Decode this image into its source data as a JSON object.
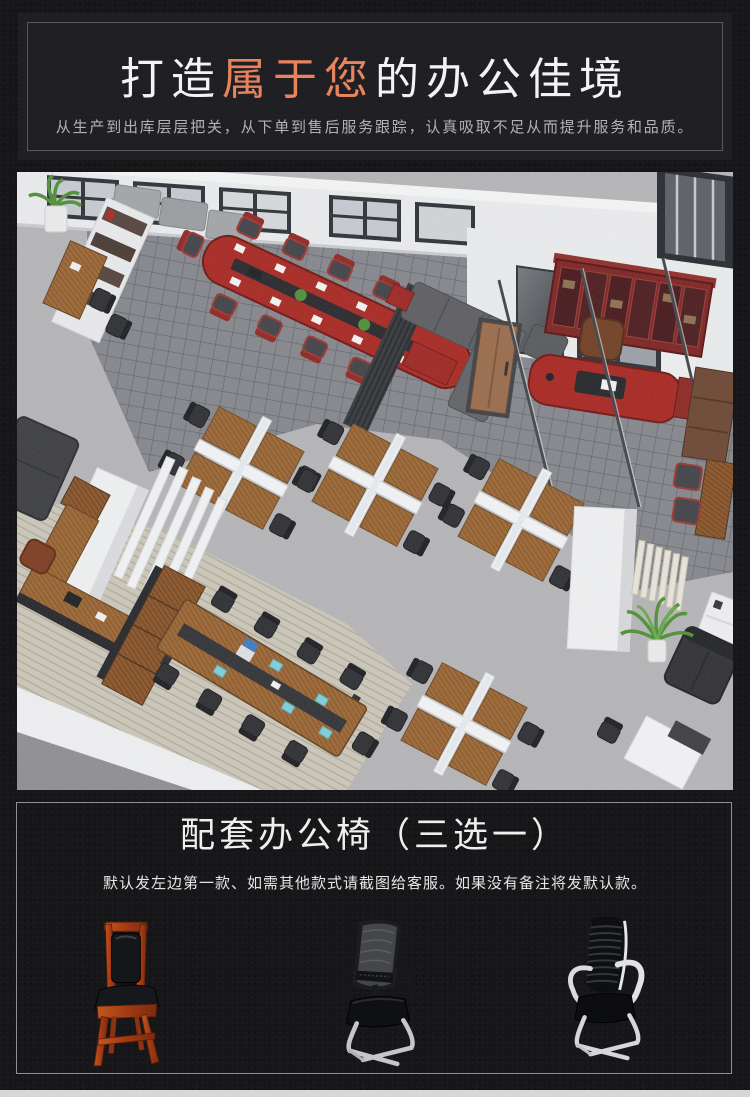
{
  "hero": {
    "title_pre": "打造",
    "title_accent": "属于您",
    "title_post": "的办公佳境",
    "subtitle": "从生产到出库层层把关，从下单到售后服务跟踪，认真吸取不足从而提升服务和品质。",
    "accent_color": "#e8835c"
  },
  "chairs_section": {
    "title": "配套办公椅（三选一）",
    "note": "默认发左边第一款、如需其他款式请截图给客服。如果没有备注将发默认款。",
    "options": [
      {
        "icon": "red-wood-leather-visitor-chair-icon"
      },
      {
        "icon": "black-mesh-cantilever-chair-icon"
      },
      {
        "icon": "black-white-ribbed-cantilever-chair-icon"
      }
    ]
  },
  "palette": {
    "page_bg": "#17171a",
    "hero_panel_bg": "#1f1f23",
    "hero_border": "#595a5e",
    "chairs_border": "#8f9093",
    "accent_orange": "#e8835c",
    "footer_strip": "#d7d7d9",
    "furniture_red": "#a8241f",
    "mahogany": "#7c2120",
    "desk_wood": "#9c6531",
    "carpet_light": "#b5b5b7",
    "carpet_dark": "#84868c",
    "carpet_beige": "#ccc7b9"
  }
}
